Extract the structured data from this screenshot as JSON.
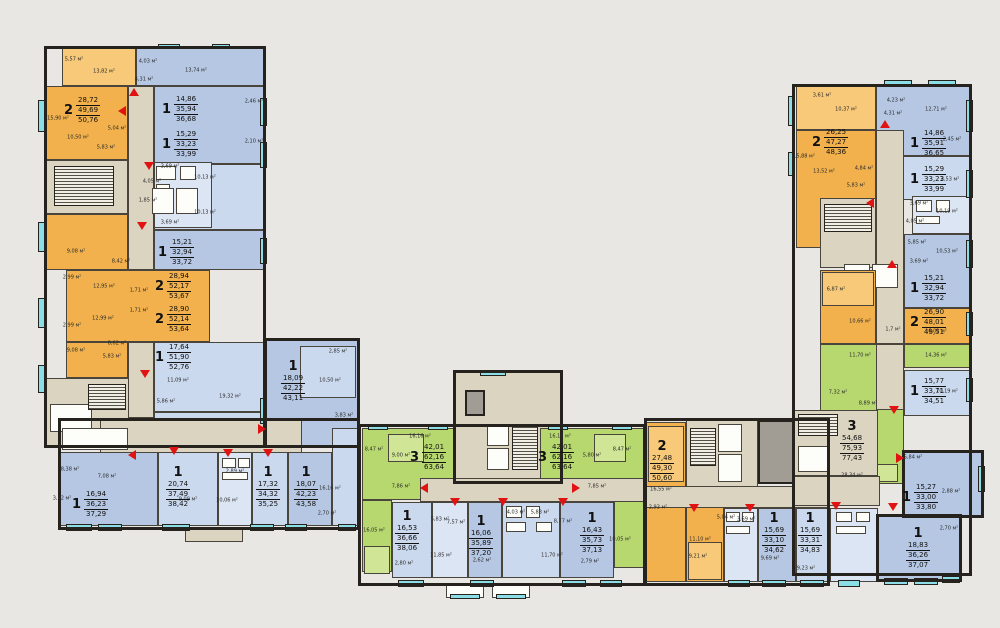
{
  "legend": {
    "one_room_color": "#b5c7e3",
    "two_room_color": "#f2b14c",
    "three_room_color": "#b7d86e",
    "corridor_color": "#dbd4c1",
    "balcony_color": "#8bdde6",
    "entrance_arrow_color": "#e01212"
  },
  "apartments": [
    {
      "rooms": "2",
      "areas": [
        "28,72",
        "49,69",
        "50,76"
      ]
    },
    {
      "rooms": "1",
      "areas": [
        "14,86",
        "35,94",
        "36,68"
      ]
    },
    {
      "rooms": "1",
      "areas": [
        "15,29",
        "33,23",
        "33,99"
      ]
    },
    {
      "rooms": "1",
      "areas": [
        "15,21",
        "32,94",
        "33,72"
      ]
    },
    {
      "rooms": "2",
      "areas": [
        "28,94",
        "52,17",
        "53,67"
      ]
    },
    {
      "rooms": "2",
      "areas": [
        "28,90",
        "52,14",
        "53,64"
      ]
    },
    {
      "rooms": "1",
      "areas": [
        "17,64",
        "51,90",
        "52,76"
      ]
    },
    {
      "rooms": "1",
      "areas": [
        "18,09",
        "42,22",
        "43,11"
      ]
    },
    {
      "rooms": "1",
      "areas": [
        "16,94",
        "36,23",
        "37,29"
      ]
    },
    {
      "rooms": "1",
      "areas": [
        "20,74",
        "37,49",
        "38,42"
      ]
    },
    {
      "rooms": "1",
      "areas": [
        "17,32",
        "34,32",
        "35,25"
      ]
    },
    {
      "rooms": "1",
      "areas": [
        "18,07",
        "42,23",
        "43,58"
      ]
    },
    {
      "rooms": "3",
      "areas": [
        "42,01",
        "62,16",
        "63,64"
      ]
    },
    {
      "rooms": "3",
      "areas": [
        "42,01",
        "62,16",
        "63,64"
      ]
    },
    {
      "rooms": "2",
      "areas": [
        "27,48",
        "49,30",
        "50,60"
      ]
    },
    {
      "rooms": "1",
      "areas": [
        "16,53",
        "36,66",
        "38,06"
      ]
    },
    {
      "rooms": "1",
      "areas": [
        "16,06",
        "35,89",
        "37,20"
      ]
    },
    {
      "rooms": "1",
      "areas": [
        "16,43",
        "35,73",
        "37,13"
      ]
    },
    {
      "rooms": "1",
      "areas": [
        "15,69",
        "33,10",
        "34,62"
      ]
    },
    {
      "rooms": "1",
      "areas": [
        "15,69",
        "33,31",
        "34,83"
      ]
    },
    {
      "rooms": "2",
      "areas": [
        "26,25",
        "47,27",
        "48,36"
      ]
    },
    {
      "rooms": "1",
      "areas": [
        "14,86",
        "35,91",
        "36,65"
      ]
    },
    {
      "rooms": "1",
      "areas": [
        "15,29",
        "33,23",
        "33,99"
      ]
    },
    {
      "rooms": "1",
      "areas": [
        "15,21",
        "32,94",
        "33,72"
      ]
    },
    {
      "rooms": "2",
      "areas": [
        "26,90",
        "48,01",
        "49,51"
      ]
    },
    {
      "rooms": "1",
      "areas": [
        "15,77",
        "33,71",
        "34,51"
      ]
    },
    {
      "rooms": "3",
      "areas": [
        "54,68",
        "75,93",
        "77,43"
      ]
    },
    {
      "rooms": "1",
      "areas": [
        "15,27",
        "33,00",
        "33,80"
      ]
    },
    {
      "rooms": "1",
      "areas": [
        "18,83",
        "36,26",
        "37,07"
      ]
    }
  ],
  "room_areas": [
    "5,57 м²",
    "13,82 м²",
    "4,03 м²",
    "13,74 м²",
    "4,31 м²",
    "15,90 м²",
    "5,04 м²",
    "10,50 м²",
    "5,83 м²",
    "3,69 м²",
    "10,13 м²",
    "4,05 м²",
    "1,85 м²",
    "10,13 м²",
    "3,69 м²",
    "2,46 м²",
    "2,10 м²",
    "9,08 м²",
    "8,42 м²",
    "2,99 м²",
    "12,95 м²",
    "1,71 м²",
    "12,99 м²",
    "2,99 м²",
    "1,71 м²",
    "8,62 м²",
    "9,08 м²",
    "5,83 м²",
    "11,09 м²",
    "5,86 м²",
    "19,32 м²",
    "2,85 м²",
    "10,50 м²",
    "3,83 м²",
    "8,38 м²",
    "7,08 м²",
    "3,52 м²",
    "9,09 м²",
    "10,06 м²",
    "2,89 м²",
    "16,16 м²",
    "2,70 м²",
    "16,16 м²",
    "8,47 м²",
    "9,00 м²",
    "7,86 м²",
    "16,15 м²",
    "5,80 м²",
    "8,47 м²",
    "7,85 м²",
    "16,05 м²",
    "5,83 м²",
    "7,57 м²",
    "4,03 м²",
    "5,83 м²",
    "8,77 м²",
    "11,85 м²",
    "11,70 м²",
    "2,80 м²",
    "2,62 м²",
    "2,79 м²",
    "10,05 м²",
    "16,55 м²",
    "2,93 м²",
    "11,10 м²",
    "9,21 м²",
    "5,04 м²",
    "3,69 м²",
    "9,69 м²",
    "3,61 м²",
    "10,37 м²",
    "4,23 м²",
    "12,71 м²",
    "4,31 м²",
    "2,45 м²",
    "15,88 м²",
    "13,52 м²",
    "4,84 м²",
    "5,83 м²",
    "2,53 м²",
    "3,69 м²",
    "10,19 м²",
    "4,05 м²",
    "5,85 м²",
    "10,53 м²",
    "3,69 м²",
    "6,87 м²",
    "10,66 м²",
    "1,7 м²",
    "16,02 м²",
    "11,70 м²",
    "14,36 м²",
    "7,32 м²",
    "8,89 м²",
    "10,19 м²",
    "28,34 м²",
    "5,84 м²",
    "2,88 м²",
    "2,70 м²",
    "9,23 м²"
  ]
}
